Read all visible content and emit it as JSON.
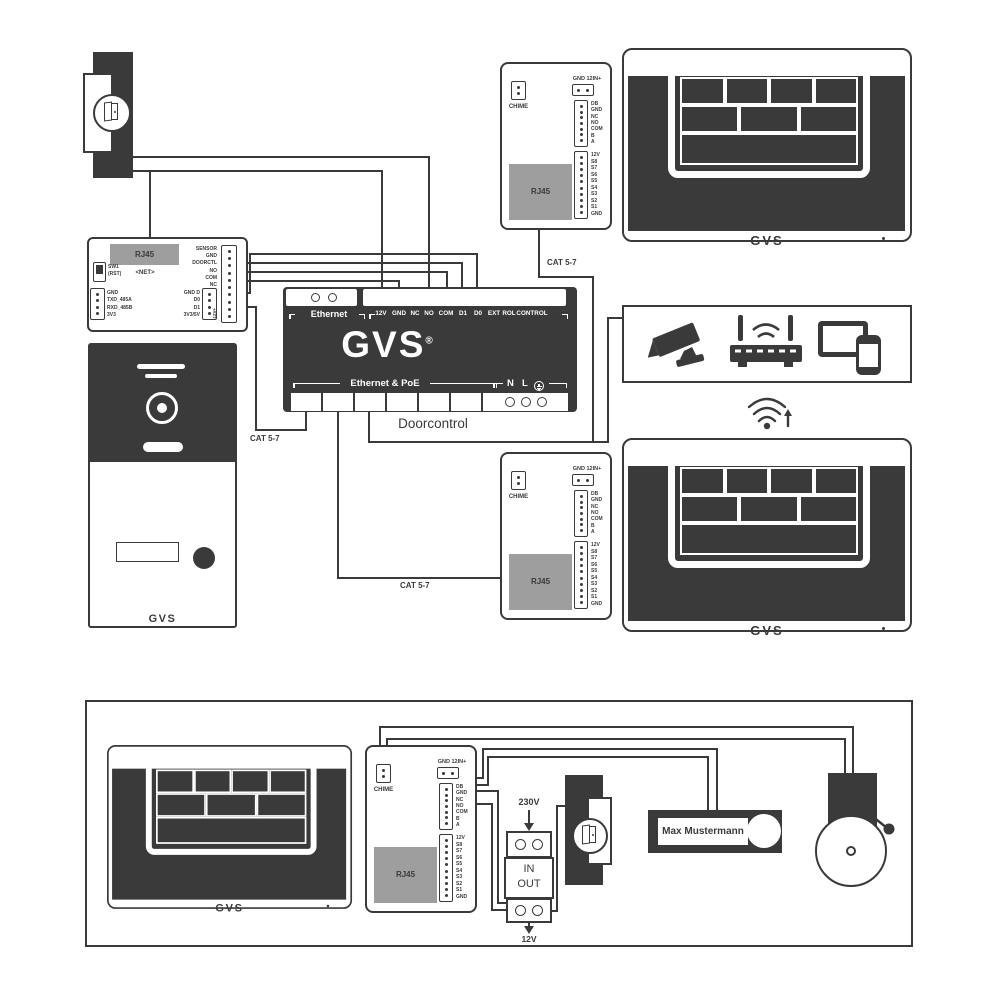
{
  "colors": {
    "ink": "#3a3a3a",
    "panel_gray": "#9e9e9e"
  },
  "net_module": {
    "rj45": "RJ45",
    "net": "<NET>",
    "sw1": "SW1",
    "rst": "(RST)",
    "right_terminals": [
      "SENSOR",
      "GND",
      "DOORCTL",
      "NO",
      "COM",
      "NC"
    ],
    "mid_terminals": [
      "GND D",
      "D0",
      "D1",
      "3V3/5V"
    ],
    "left_terminals": [
      "GND",
      "TXD_485A",
      "RXD_485B",
      "3V3"
    ],
    "side_label": "-12V+"
  },
  "doorstation": {
    "brand": "GVS"
  },
  "doorcontrol": {
    "ethernet_label": "Ethernet",
    "terminals": [
      "12V",
      "GND",
      "NC",
      "NO",
      "COM",
      "D1",
      "D0",
      "EXT",
      "ROL",
      "CONTROL"
    ],
    "brand": "GVS",
    "reg": "®",
    "poe_label": "Ethernet & PoE",
    "n": "N",
    "l": "L",
    "title": "Doorcontrol"
  },
  "cat_labels": {
    "a": "CAT 5-7",
    "b": "CAT 5-7",
    "c": "CAT 5-7"
  },
  "chime_module": {
    "chime": "CHIME",
    "power_label": "GND 12IN+",
    "block1": [
      "DB",
      "GND",
      "NC",
      "NO",
      "COM",
      "B",
      "A"
    ],
    "block2": [
      "12V",
      "S8",
      "S7",
      "S6",
      "S5",
      "S4",
      "S3",
      "S2",
      "S1",
      "GND"
    ],
    "rj45": "RJ45"
  },
  "monitor": {
    "brand": "GVS"
  },
  "power_supply": {
    "input": "230V",
    "in": "IN",
    "out": "OUT",
    "output": "12V"
  },
  "doorbell": {
    "name": "Max Mustermann"
  }
}
